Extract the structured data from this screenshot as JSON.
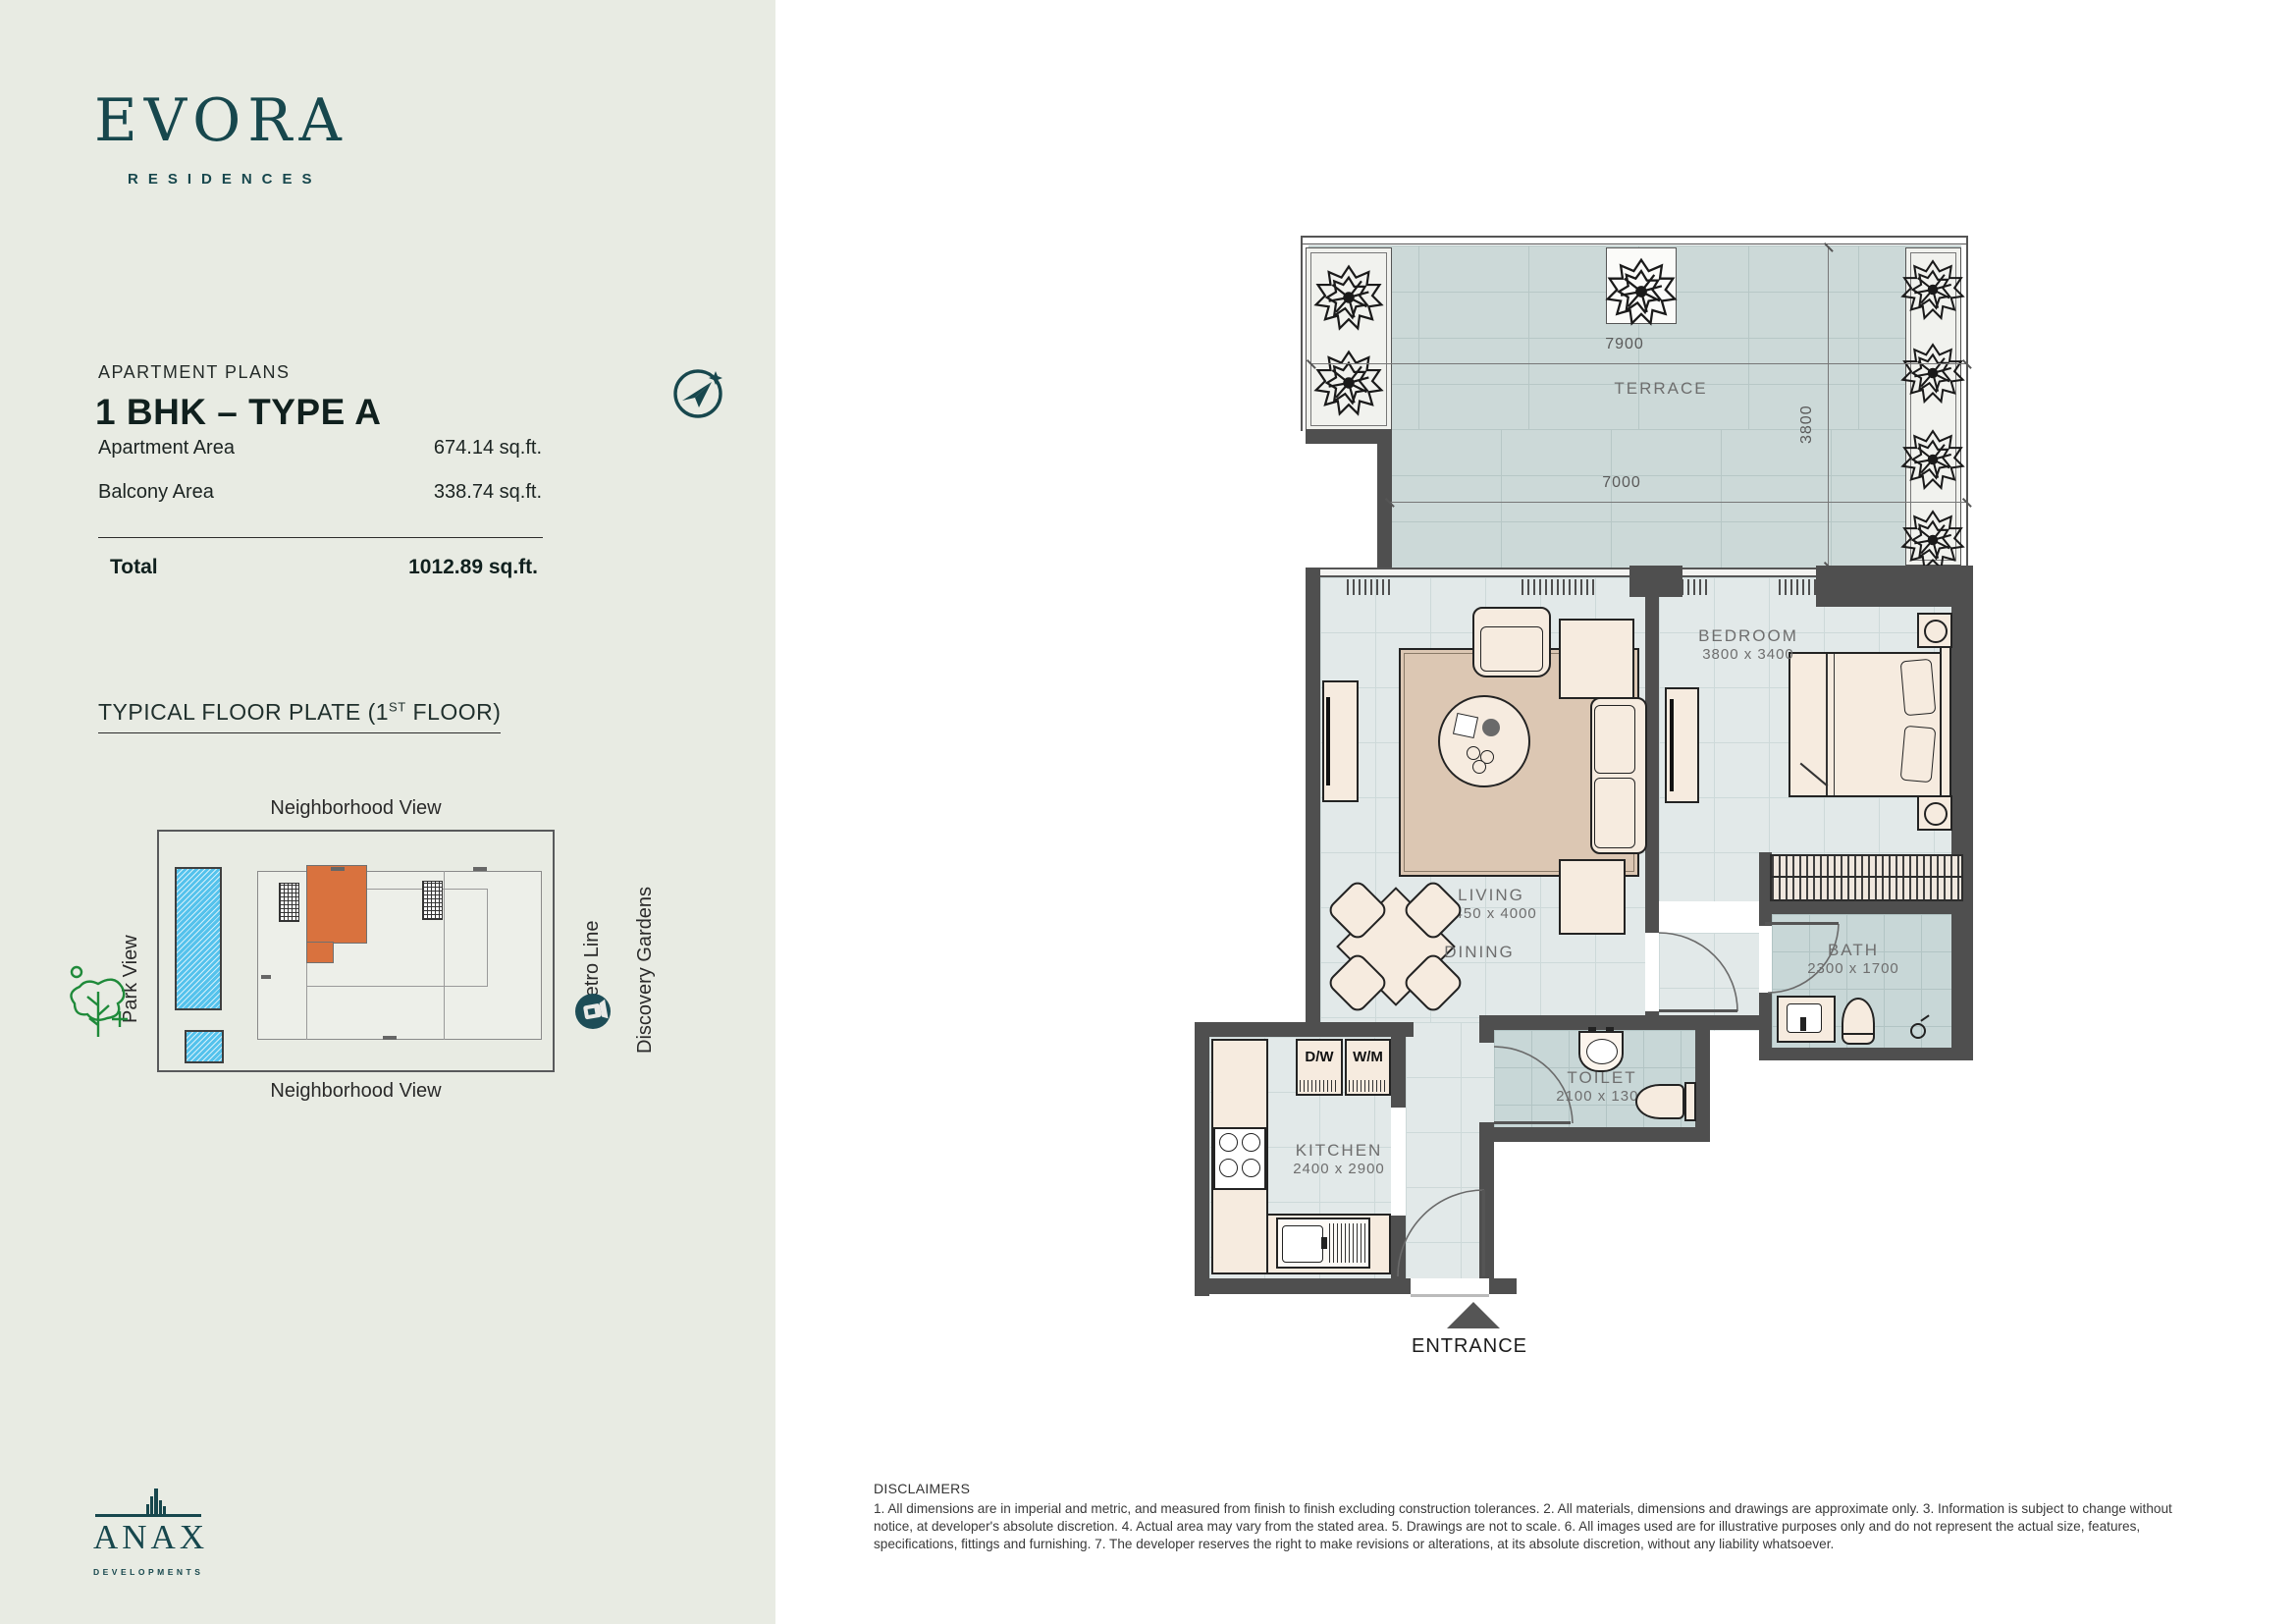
{
  "brand": {
    "name": "EVORA",
    "tagline": "RESIDENCES"
  },
  "plan_header": {
    "eyebrow": "APARTMENT PLANS",
    "title": "1 BHK – TYPE A"
  },
  "areas": {
    "apartment": {
      "label": "Apartment Area",
      "value": "674.14 sq.ft."
    },
    "balcony": {
      "label": "Balcony Area",
      "value": "338.74 sq.ft."
    },
    "total": {
      "label": "Total",
      "value": "1012.89 sq.ft."
    }
  },
  "floor_plate": {
    "title_prefix": "TYPICAL FLOOR PLATE (1",
    "title_sup": "ST",
    "title_suffix": " FLOOR)",
    "top_label": "Neighborhood View",
    "bottom_label": "Neighborhood View",
    "left_label": "Park View",
    "metro_label": "Metro Line",
    "right_label": "Discovery Gardens"
  },
  "plan": {
    "terrace": {
      "name": "TERRACE",
      "dim_top": "7900",
      "dim_side": "3800",
      "dim_bottom": "7000"
    },
    "living": {
      "name": "LIVING",
      "dim": "5450 x 4000"
    },
    "dining": {
      "name": "DINING"
    },
    "bedroom": {
      "name": "BEDROOM",
      "dim": "3800 x 3400"
    },
    "bath": {
      "name": "BATH",
      "dim": "2300 x 1700"
    },
    "toilet": {
      "name": "TOILET",
      "dim": "2100 x 1300"
    },
    "kitchen": {
      "name": "KITCHEN",
      "dim": "2400 x 2900"
    },
    "appliances": {
      "dishwasher": "D/W",
      "washing_machine": "W/M"
    },
    "entrance_label": "ENTRANCE"
  },
  "disclaimers": {
    "title": "DISCLAIMERS",
    "body": "1. All dimensions are in imperial and metric, and measured from finish to finish excluding construction tolerances. 2. All materials, dimensions and drawings are approximate only. 3. Information is subject to change without notice, at developer's absolute discretion. 4. Actual area may vary from the stated area. 5. Drawings are not to scale. 6. All images used are for illustrative purposes only and do not represent the actual size, features, specifications, fittings and furnishing. 7. The developer reserves the right to make revisions or alterations, at its absolute discretion, without any liability whatsoever."
  },
  "developer": {
    "name": "ANAX",
    "subtitle": "DEVELOPMENTS"
  },
  "colors": {
    "brand_teal": "#17474d",
    "accent_orange": "#d9723e",
    "wall_gray": "#4f4f4f",
    "pool_blue": "#54c2ec",
    "park_green": "#1f8a3a"
  }
}
